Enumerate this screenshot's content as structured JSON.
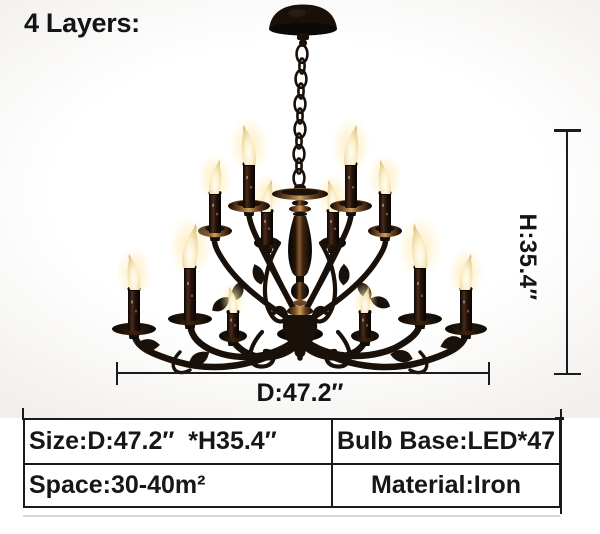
{
  "colors": {
    "bg": "#ffffff",
    "photo_tint": "#f2f0ed",
    "text": "#141414",
    "iron": "#181009",
    "bronze": "#8a5a30",
    "flame_core": "#fffdf2",
    "flame_edge": "#d9b877",
    "dim_line": "#1c1c1c",
    "table_border": "#1a1a1a"
  },
  "annotations": {
    "layers_label": "4 Layers:",
    "height_label": "H:35.4″",
    "diameter_label": "D:47.2″"
  },
  "spec_table": {
    "rows": [
      {
        "left": "Size:D:47.2″  *H35.4″",
        "right": "Bulb Base:LED*47"
      },
      {
        "left": "Space:30-40m²",
        "right": "Material:Iron"
      }
    ]
  }
}
